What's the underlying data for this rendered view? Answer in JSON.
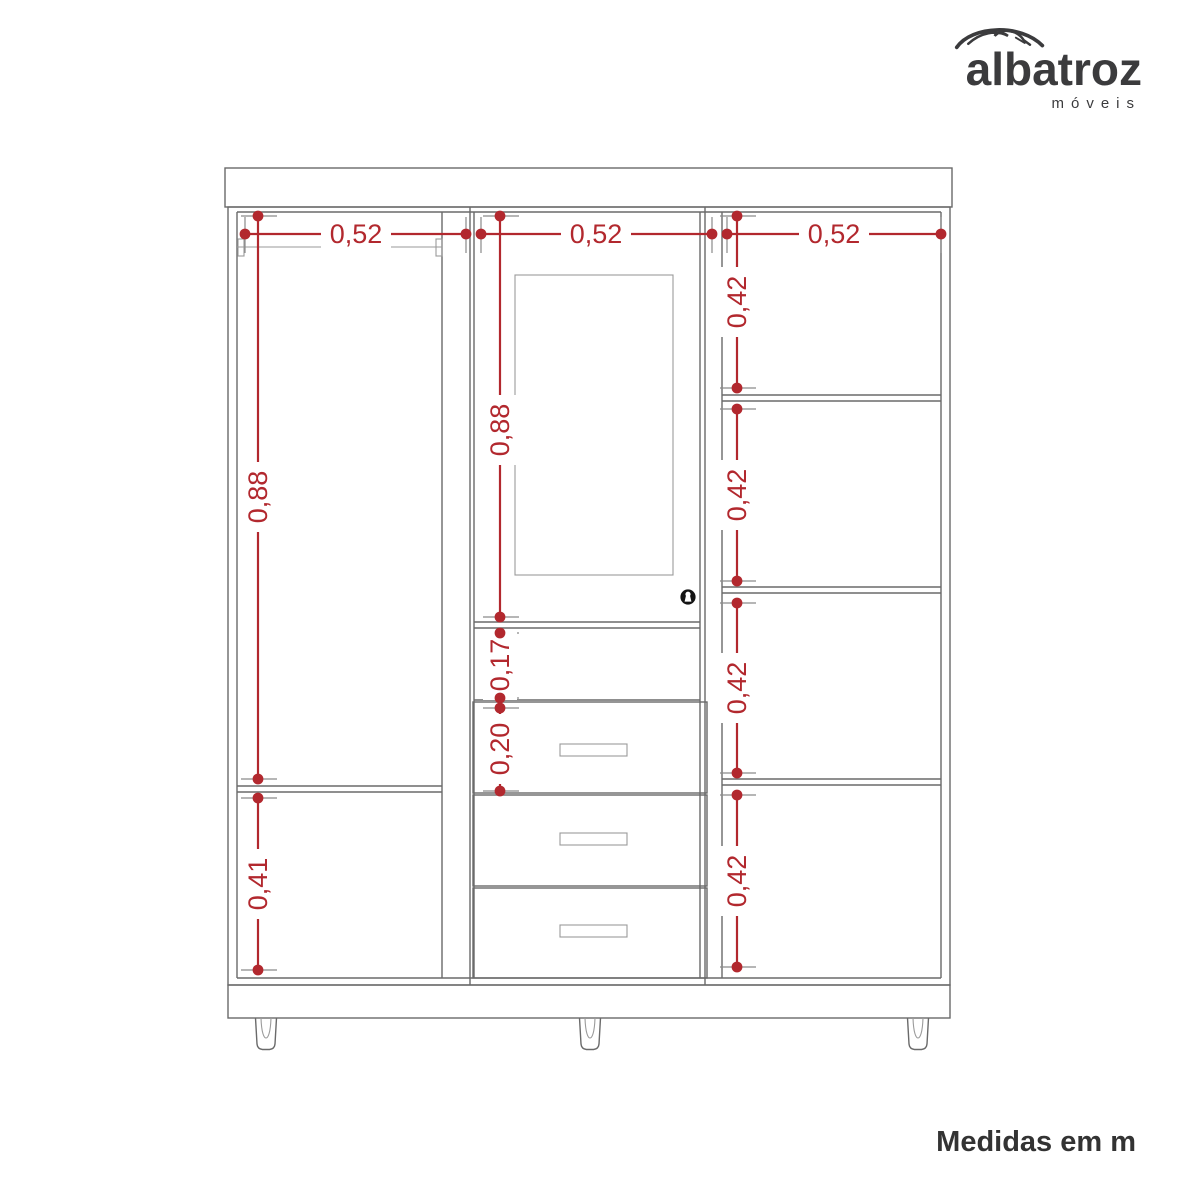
{
  "brand": {
    "name": "albatroz",
    "tagline": "móveis"
  },
  "footer": {
    "note": "Medidas em m"
  },
  "icons": {
    "logo": "bird-swoosh",
    "door_lock": "keyhole"
  },
  "colors": {
    "dimension_red": "#B2282E",
    "line_gray": "#6a6a6a",
    "brand_ink": "#3b3b3d"
  },
  "diagram": {
    "unit": "m",
    "top_widths": {
      "left": "0,52",
      "middle": "0,52",
      "right": "0,52"
    },
    "left_col": {
      "upper": "0,88",
      "lower": "0,41"
    },
    "mid_col": {
      "door": "0,88",
      "niche": "0,17",
      "drawer": "0,20"
    },
    "right_col": {
      "s1": "0,42",
      "s2": "0,42",
      "s3": "0,42",
      "s4": "0,42"
    }
  }
}
